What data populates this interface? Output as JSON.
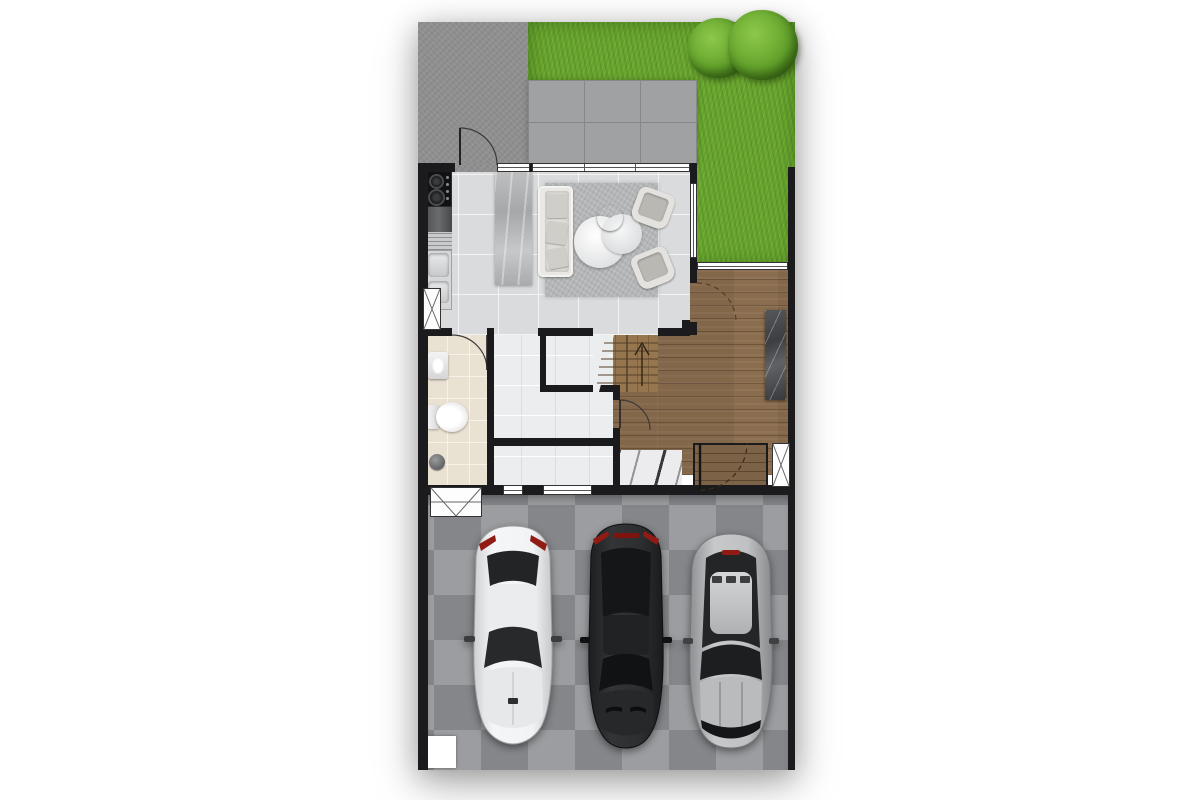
{
  "palette": {
    "page_bg": "#ffffff",
    "wall": "#1b1b1d",
    "concrete": "#8f8f90",
    "grass": "#69a52e",
    "tree_light": "#8cc94b",
    "tree_dark": "#3f7015",
    "patio": "#9fa1a3",
    "patio_grout": "#85878a",
    "tile": "#d9dbdd",
    "tile_grout": "#f2f3f4",
    "bath": "#e9e1d2",
    "bath_grout": "#f7f2e8",
    "white_room": "#ebedee",
    "wood": "#8a6d4e",
    "stair_wood": "#95764f",
    "garage_light": "#9b9da0",
    "garage_dark": "#84868a",
    "car_white": "#f2f3f4",
    "car_black": "#26282a",
    "car_silver": "#aeb0b3",
    "taillight_red": "#8f1b14",
    "door_arc": "#3a3a3a"
  },
  "plan": {
    "type": "townhouse-ground-floor-plan",
    "areas": [
      {
        "id": "side-yard-concrete",
        "name": "concrete side yard"
      },
      {
        "id": "garden-lawn",
        "name": "garden lawn with trees"
      },
      {
        "id": "patio-tiles",
        "name": "tiled patio"
      },
      {
        "id": "living-dining",
        "name": "living room"
      },
      {
        "id": "kitchen",
        "name": "kitchenette"
      },
      {
        "id": "stairs",
        "name": "staircase"
      },
      {
        "id": "under-stair-storage",
        "name": "under-stair storage"
      },
      {
        "id": "bathroom",
        "name": "bathroom"
      },
      {
        "id": "utility-room",
        "name": "utility room"
      },
      {
        "id": "hallway-wood",
        "name": "wooden entrance hall"
      },
      {
        "id": "entrance-porch",
        "name": "entrance porch"
      },
      {
        "id": "garage-driveway",
        "name": "parking driveway"
      }
    ],
    "fixtures": [
      {
        "id": "cooktop",
        "name": "two-burner cooktop"
      },
      {
        "id": "kitchen-sink",
        "name": "double kitchen sink"
      },
      {
        "id": "island-counter",
        "name": "stone island counter"
      },
      {
        "id": "sofa",
        "name": "sofa"
      },
      {
        "id": "area-rug",
        "name": "area rug"
      },
      {
        "id": "coffee-tables",
        "name": "round nesting coffee tables"
      },
      {
        "id": "armchair-top",
        "name": "armchair"
      },
      {
        "id": "armchair-bottom",
        "name": "armchair"
      },
      {
        "id": "washbasin",
        "name": "washbasin"
      },
      {
        "id": "toilet",
        "name": "toilet"
      },
      {
        "id": "shower-drain",
        "name": "shower drain"
      },
      {
        "id": "console-marble",
        "name": "marble console"
      },
      {
        "id": "marble-threshold",
        "name": "marble threshold"
      },
      {
        "id": "tree-1",
        "name": "tree"
      },
      {
        "id": "tree-2",
        "name": "tree"
      }
    ],
    "vehicles": [
      {
        "id": "car-white",
        "name": "white sedan, top view"
      },
      {
        "id": "car-black",
        "name": "black sedan, top view"
      },
      {
        "id": "car-silver",
        "name": "silver sedan, top view"
      }
    ]
  }
}
